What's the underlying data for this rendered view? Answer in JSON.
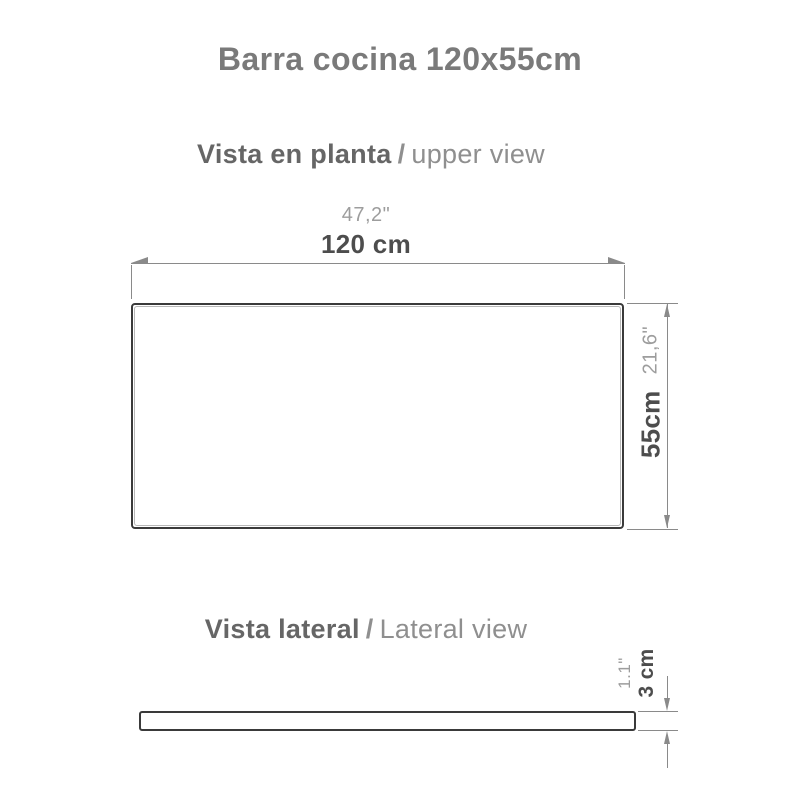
{
  "title": "Barra cocina 120x55cm",
  "plan_view": {
    "heading": {
      "bold": "Vista en planta",
      "separator": "/",
      "light": "upper view"
    },
    "width": {
      "inches": "47,2\"",
      "cm": "120 cm"
    },
    "depth": {
      "cm": "55cm",
      "inches": "21,6\""
    }
  },
  "lateral_view": {
    "heading": {
      "bold": "Vista lateral",
      "separator": "/",
      "light": "Lateral view"
    },
    "thickness": {
      "inches": "1.1\"",
      "cm": "3 cm"
    }
  },
  "colors": {
    "title": "#7a7a7a",
    "heading_bold": "#666666",
    "heading_light": "#8f8f8f",
    "dim_value_cm": "#4d4d4d",
    "dim_value_inches": "#9d9d9d",
    "dim_lines": "#8a8a8a",
    "outline": "#3a3a3a"
  }
}
